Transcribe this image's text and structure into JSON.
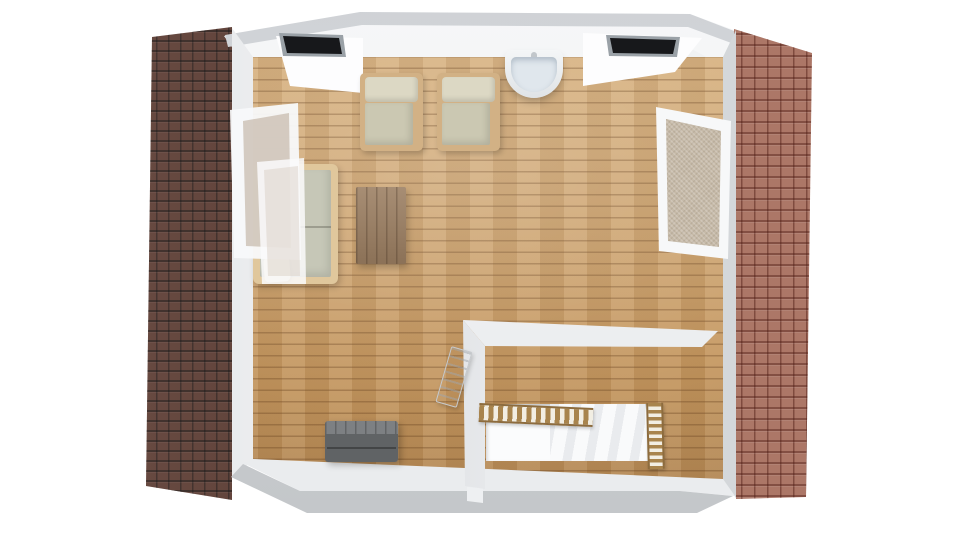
{
  "meta": {
    "view": "3D architectural floor plan, top-down render of an attic room",
    "background": "#ffffff"
  },
  "colors": {
    "bg": "#ffffff",
    "roof-left-tile": "#563329",
    "roof-right-tile": "#c08473",
    "roof-band": "#cfd2d6",
    "dormer-slot": "#17181b",
    "floor-wood": "#c89b63",
    "window-glass": "#c6baa8",
    "chair-frame": "#d2b185",
    "chair-back": "#dcd8c4",
    "chair-seat": "#cbc8b2",
    "sofa-frame": "#e0c79c",
    "sofa-cushion": "#c6c7b7",
    "pillow": "#ece5cf",
    "table-wood": "#9b7e61",
    "chest-lid": "#7d8083",
    "chest-body": "#606365",
    "sink-bowl": "#e0e7ed",
    "stair-wood": "#a8844d"
  },
  "scene": {
    "room": {
      "label": "Attic room with wooden plank floor"
    },
    "objects": [
      {
        "id": "roof-left",
        "label": "Left sloped roof with dark brown tiles"
      },
      {
        "id": "roof-right",
        "label": "Right sloped roof with terracotta tiles"
      },
      {
        "id": "top-wall",
        "label": "Top wall with two dormer window openings"
      },
      {
        "id": "dormer-left",
        "label": "Left dormer window opening"
      },
      {
        "id": "dormer-right",
        "label": "Right dormer window opening"
      },
      {
        "id": "wall-sink",
        "label": "Wall-mounted washbasin"
      },
      {
        "id": "armchair-left",
        "label": "Beige armchair (left)"
      },
      {
        "id": "armchair-right",
        "label": "Beige armchair (right)"
      },
      {
        "id": "sofa-daybed",
        "label": "Wooden daybed sofa with cushion and pillow"
      },
      {
        "id": "coffee-table",
        "label": "Rectangular wooden coffee table"
      },
      {
        "id": "skylight-left",
        "label": "Open skylight window, left wall"
      },
      {
        "id": "skylight-right",
        "label": "Skylight window, right wall"
      },
      {
        "id": "storage-chest",
        "label": "Dark grey storage chest"
      },
      {
        "id": "stair-partition",
        "label": "White half-wall around staircase"
      },
      {
        "id": "stair-opening",
        "label": "Staircase opening with descending steps"
      },
      {
        "id": "stair-balustrade",
        "label": "Wooden balustrade along stair opening"
      },
      {
        "id": "stair-railing",
        "label": "Wooden side railing of staircase"
      },
      {
        "id": "hatch-door",
        "label": "Open hatch door by the staircase"
      },
      {
        "id": "bottom-wall",
        "label": "Bottom wall ledge"
      }
    ]
  }
}
